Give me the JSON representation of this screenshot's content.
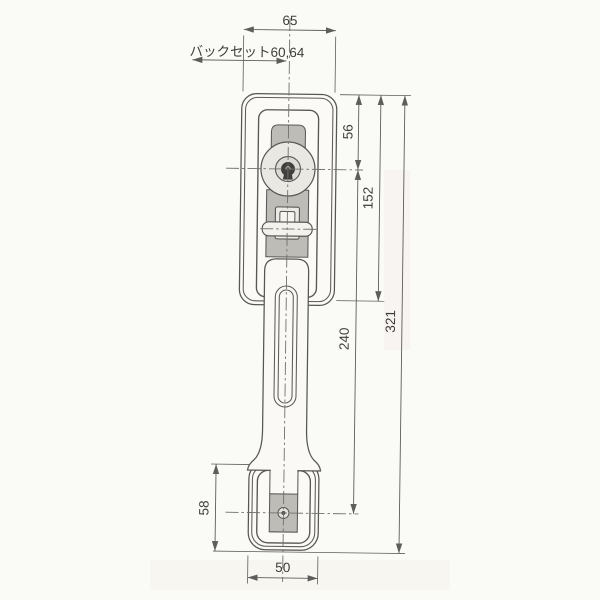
{
  "drawing": {
    "dimensions": {
      "top_width": "65",
      "backset": "バックセット60,64",
      "cylinder_offset": "56",
      "plate_height": "152",
      "handle_span": "240",
      "overall_length": "321",
      "bottom_plate_height": "58",
      "bottom_plate_width": "50"
    }
  }
}
